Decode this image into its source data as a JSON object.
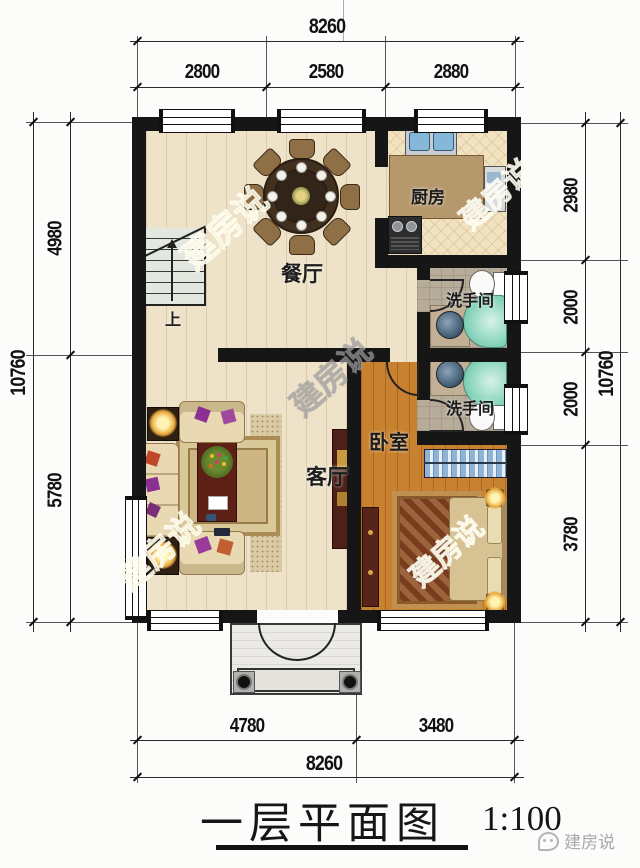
{
  "watermark_text": "建房说",
  "plan": {
    "rooms": {
      "kitchen": "厨房",
      "dining": "餐厅",
      "bathroom_upper": "洗手间",
      "bathroom_lower": "洗手间",
      "living": "客厅",
      "bedroom": "卧室"
    },
    "stairs_up_label": "上"
  },
  "dimensions": {
    "top": {
      "total": "8260",
      "segments": [
        "2800",
        "2580",
        "2880"
      ]
    },
    "bottom": {
      "total": "8260",
      "segments": [
        "4780",
        "3480"
      ]
    },
    "left": {
      "total": "10760",
      "segments": [
        "4980",
        "5780"
      ]
    },
    "right": {
      "total": "10760",
      "segments": [
        "2980",
        "2000",
        "2000",
        "3780"
      ]
    }
  },
  "title": {
    "text": "一层平面图",
    "scale": "1:100"
  },
  "logo": {
    "text": "建房说"
  }
}
